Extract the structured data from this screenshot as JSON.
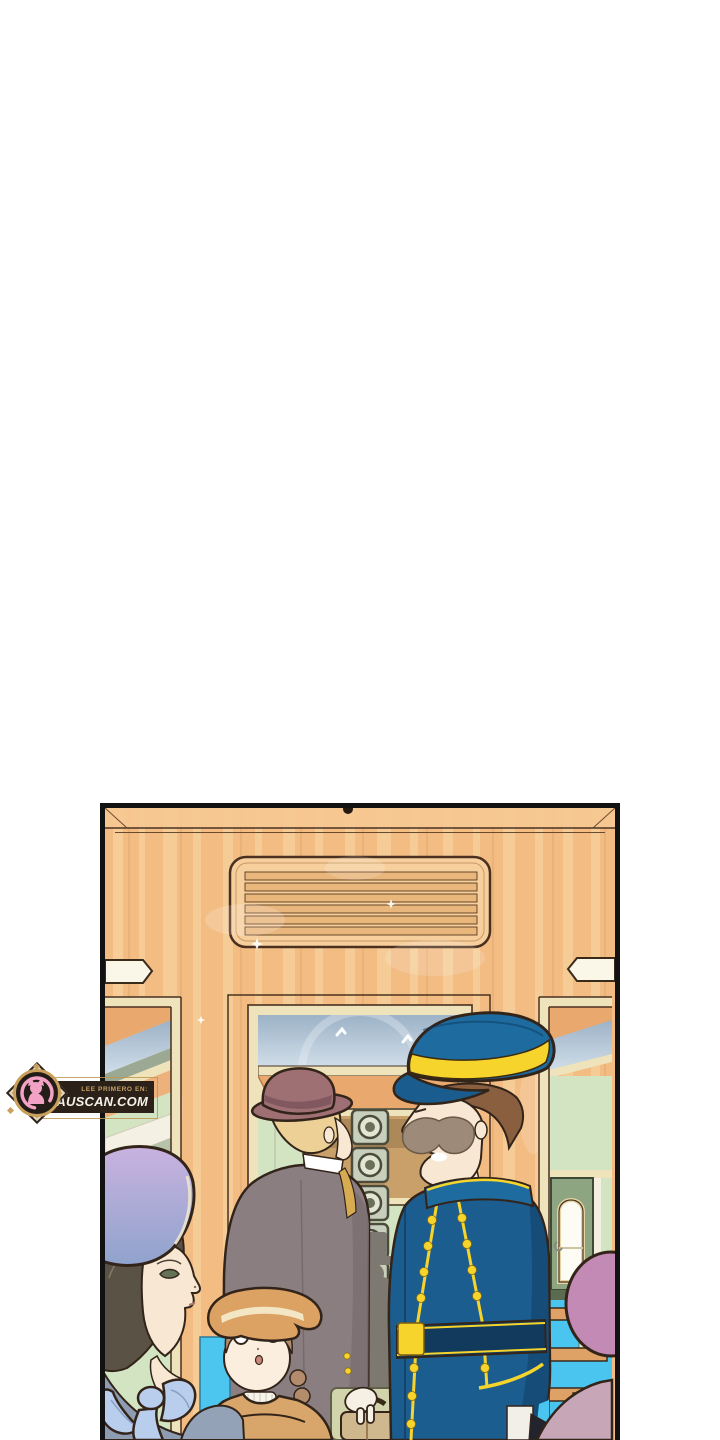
{
  "page": {
    "kind": "webtoon page",
    "bg": "#ffffff"
  },
  "watermark": {
    "line1": "LEE PRIMERO EN:",
    "line2": "MIAUSCAN.COM",
    "icon": "cat-icon",
    "colors": {
      "ribbon_bg": "#2b2118",
      "gold": "#c9a05c",
      "text_small": "#c8a368",
      "text_big": "#f5f2ea",
      "cat_pink": "#f2a3c5",
      "circle_bg": "#241c16",
      "badge_bg": "#e7d8c0",
      "badge_border": "#2c241e"
    }
  },
  "panel": {
    "scene": "Wood-panelled vintage train car with passengers and a conductor",
    "figures": [
      "louvered vent",
      "grab handles",
      "transom windows",
      "green interior door",
      "stacked metal cases",
      "background silhouettes",
      "conductor in blue uniform with yellow trim and peaked cap",
      "gentleman in mauve fedora and taupe coat",
      "woman in lavender bonnet with blue bow",
      "girl in tan hat with braids",
      "suitcase",
      "turquoise boarding steps",
      "pink bonnet figure"
    ],
    "palette": {
      "page_bg": "#ffffff",
      "panel_border": "#121212",
      "outline": "#33241a",
      "wood": "#f2bc83",
      "wood_light": "#fbdca9",
      "wood_line": "#e0a169",
      "vent_fill": "#f7cf9d",
      "slat": "#e9b67c",
      "cream": "#efe3bc",
      "glass_top": "#9db2c7",
      "glass_bottom": "#cfdde8",
      "interior_green": "#d3e4c3",
      "green_dark": "#9aa894",
      "ceiling_wood": "#e9a96e",
      "door_green": "#8da581",
      "stairs_cyan": "#4ac5ef",
      "step_wood": "#dfa266",
      "uniform_blue": "#1c5d8f",
      "uniform_dark": "#154a75",
      "cap_blue": "#1e6ba0",
      "trim_yellow": "#f6d42c",
      "skin": "#f8e7d3",
      "mustache": "#9e8a79",
      "conductor_hair": "#8a5f3f",
      "man_hat": "#9e6f73",
      "man_hat_band": "#815860",
      "man_hair": "#ecd096",
      "man_coat": "#8b7e81",
      "vest_mustard": "#d6ab52",
      "bonnet_top": "#c9b2e0",
      "bonnet_bottom": "#8fa3cc",
      "woman_hair": "#5b5246",
      "ribbon_blue": "#b9cdec",
      "woman_dress": "#8d9cb0",
      "girl_hat": "#dba263",
      "girl_hat_band": "#f3e6c4",
      "girl_hair": "#b28c6b",
      "girl_coat": "#d8a66b",
      "silhouette": "#8f8b85",
      "silhouette_dark": "#6b6661",
      "suitcase_tan": "#cfb88e",
      "sage": "#d2d5ab",
      "pink_hat": "#c28ab4",
      "mauve_shoulder": "#c7a6b8",
      "tower_metal": "#c9cfbd",
      "tower_dark": "#4c4c3c"
    }
  }
}
